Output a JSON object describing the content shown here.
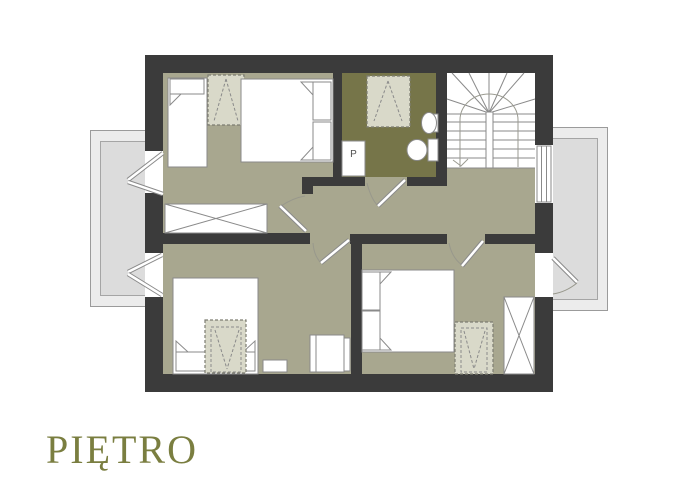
{
  "title": {
    "label": "PIĘTRO"
  },
  "bathroom": {
    "washer_label": "P"
  },
  "colors": {
    "wall": "#3b3b3b",
    "floor": "#a8a78f",
    "bathroom_floor": "#767549",
    "balcony_outer": "#ececec",
    "balcony_inner": "#dcdcdc",
    "wardrobe_fill": "#d9d9c9",
    "title_color": "#7a7e40"
  },
  "icons": [
    "single-bed-icon",
    "double-bed-icon",
    "wardrobe-dashed-icon",
    "shower-icon",
    "washing-machine-icon",
    "sink-icon",
    "toilet-icon",
    "staircase-icon",
    "crossed-cabinet-icon",
    "armchair-icon",
    "bedside-table-icon",
    "door-swing-icon",
    "window-icon",
    "balcony-icon"
  ]
}
